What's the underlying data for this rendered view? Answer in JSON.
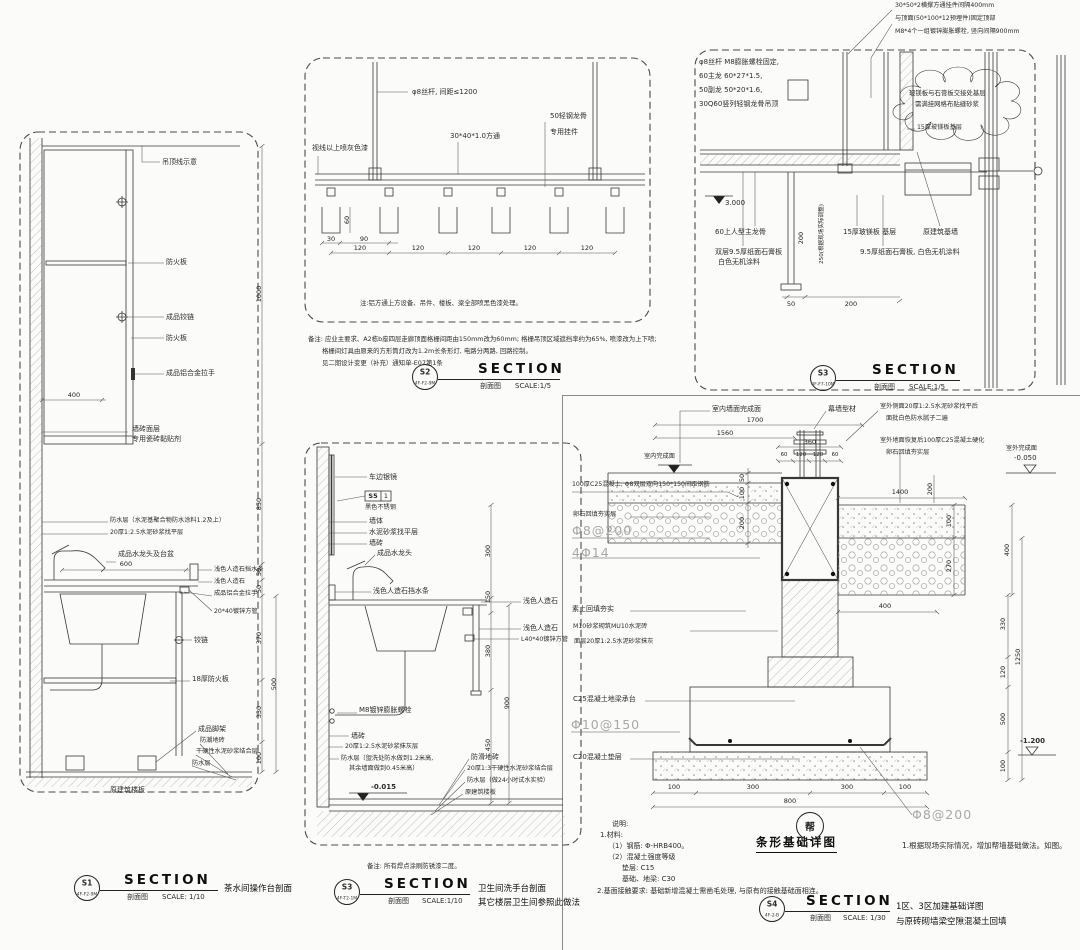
{
  "s1": {
    "lbl_ceiling": "吊顶线示意",
    "lbl_fireboard_a": "防火板",
    "lbl_hinge_a": "成品铰链",
    "lbl_fireboard_b": "防火板",
    "lbl_handle_a": "成品铝合金拉手",
    "dim_400": "400",
    "lbl_tile_a": "墙砖面层",
    "lbl_tile_b": "专用瓷砖黏贴剂",
    "lbl_wp_a": "防水层（水泥基聚合物防水涂料1.2及上）",
    "lbl_screed": "20厚1:2.5水泥砂浆找平层",
    "lbl_faucet": "成品水龙头及台盆",
    "dim_600": "600",
    "lbl_splash": "浅色人造石挡水条",
    "lbl_stone": "浅色人造石",
    "lbl_handle_b": "成品铝合金拉手",
    "lbl_tube": "20*40镀锌方管",
    "lbl_hinge_b": "铰链",
    "lbl_board18": "18厚防火板",
    "lbl_feet": "成品脚架",
    "lbl_floor_tile": "防潮地砖",
    "lbl_bond": "干硬性水泥砂浆结合层",
    "lbl_wp_b": "防水层",
    "lbl_slab": "原建筑楼板",
    "dim_1000": "1000",
    "dim_850": "850",
    "dim_50a": "50",
    "dim_50b": "50",
    "dim_370": "370",
    "dim_500": "500",
    "dim_330": "330",
    "dim_100": "100",
    "badge": {
      "id": "S1",
      "code": "4F-F2-9M",
      "sec": "SECTION",
      "cn": "剖面图",
      "scale": "SCALE: 1/10",
      "caption": "茶水间操作台剖面"
    }
  },
  "s2": {
    "lbl_rod": "φ8丝杆, 间距≤1200",
    "lbl_tube": "30*40*1.0方通",
    "lbl_keel": "50轻钢龙骨",
    "lbl_clip": "专用挂件",
    "lbl_paint": "视线以上喷灰色漆",
    "dim_60": "60",
    "dim_30": "30",
    "dim_90": "90",
    "dim_120": "120",
    "note": "注:铝方通上方设备、吊件、楼板、梁全部喷黑色漆处理。",
    "remark1": "备注: 应业主要求、A2栋b座四层走廊顶面格栅间距由150mm改为60mm; 格栅吊顶区域遮挡率约为65%, 喷漆改为上下喷;",
    "remark2": "格栅间灯具由原来的方形筒灯改为1.2m长条形灯, 电路分两路, 回路控制。",
    "remark3": "见二期设计变更（补充）通知单-E07第1条",
    "badge": {
      "id": "S2",
      "code": "4F-F2-9M",
      "sec": "SECTION",
      "cn": "剖面图",
      "scale": "SCALE:1/5"
    }
  },
  "s3": {
    "top1": "30*50*2横撑方通挂件间隔400mm",
    "top2": "与顶面(50*100*12预埋件)固定顶部",
    "top3": "M8*4个一组镀锌膨胀螺栓, 竖向间隔900mm",
    "left1": "φ8丝杆 M8膨胀螺栓固定,",
    "left2": "60主龙 60*27*1.5,",
    "left3": "50副龙 50*20*1.6,",
    "left4": "30Q60竖列轻钢龙骨吊顶",
    "cloud1": "玻镁板与石膏板交接处基层",
    "cloud2": "需满挂网格布贴缝砂浆",
    "lbl_mg15": "15厚玻镁板基层",
    "elev": "3.000",
    "lbl_keel": "60上人型主龙骨",
    "lbl_gyp_a1": "双层9.5厚纸面石膏板",
    "lbl_gyp_a2": "白色无机涂料",
    "lbl_mg_base": "15厚玻镁板 基层",
    "lbl_wall": "原建筑基墙",
    "lbl_gyp_b": "9.5厚纸面石膏板, 白色无机涂料",
    "dim_50": "50",
    "dim_200": "200",
    "vdim_200": "200",
    "vnote": "250(根据现场实际调整)",
    "badge": {
      "id": "S3",
      "code": "4F-F7-10M",
      "sec": "SECTION",
      "cn": "剖面图",
      "scale": "SCALE:1/5"
    }
  },
  "s5": {
    "lbl_mirror": "车边银镜",
    "tag_id": "S5",
    "tag_no": "1",
    "tag_mat": "黑色不锈钢",
    "lbl_wall": "墙体",
    "lbl_level": "水泥砂浆找平层",
    "lbl_tile_a": "墙砖",
    "lbl_faucet": "成品水龙头",
    "lbl_splash": "浅色人造石挡水条",
    "lbl_stone_a": "浅色人造石",
    "lbl_stone_b": "浅色人造石",
    "lbl_angle": "L40*40镀锌方管",
    "lbl_anchor": "M8镀锌膨胀螺栓",
    "lbl_tile_b": "墙砖",
    "lbl_plaster": "20厚1:2.5水泥砂浆抹灰层",
    "lbl_wp1": "防水层（盥洗处防水做到1.2米高,",
    "lbl_wp2": "其余墙面做到0.45米高）",
    "lbl_floor": "防滑地砖",
    "lbl_bond": "20厚1:3干硬性水泥砂浆结合层",
    "lbl_wp3": "防水层（做24小时试水实验）",
    "lbl_slab": "原建筑楼板",
    "elev": "-0.015",
    "dim_300": "300",
    "dim_150": "150",
    "dim_380": "380",
    "dim_900": "900",
    "dim_450": "450",
    "note": "备注: 所有焊点涂刷防锈漆二度。",
    "badge": {
      "id": "S3",
      "code": "4F-T2-1M",
      "sec": "SECTION",
      "cn": "剖面图",
      "scale": "SCALE:1/10",
      "caption1": "卫生间洗手台剖面",
      "caption2": "其它楼层卫生间参照此做法"
    }
  },
  "s4": {
    "lbl_indoor_fin": "室内墙面完成面",
    "lbl_mullion": "幕墙型材",
    "out1a": "室外侧面20厚1:2.5水泥砂浆找平后",
    "out1b": "面批白色防水腻子二遍",
    "out2a": "室外地面恢复后100厚C25混凝土硬化",
    "out2b": "卵石回填夯实层",
    "lbl_indoor": "室内完成面",
    "lbl_outdoor": "室外完成面",
    "elev_out": "-0.050",
    "lbl_slab100": "100厚C25混凝土, Φ8双层双向150*150间距钢筋",
    "lbl_pebble": "卵石回填夯实层",
    "reb1": "Φ8@200",
    "reb2": "4Φ14",
    "reb3": "Φ10@150",
    "reb4": "Φ8@200",
    "lbl_soil": "素土回填夯实",
    "lbl_brick": "M10砂浆砌筑MU10水泥砖",
    "lbl_face20": "面层20厚1:2.5水泥砂浆抹灰",
    "lbl_beam": "C25混凝土地梁承台",
    "lbl_cushion": "C20混凝土垫层",
    "d1700": "1700",
    "d1560": "1560",
    "d360": "360",
    "d60a": "60",
    "d120a": "120",
    "d120b": "120",
    "d60b": "60",
    "d50": "50",
    "d100a": "100",
    "d200a": "200",
    "d1400": "1400",
    "d100b": "100",
    "d270": "270",
    "d200b": "200",
    "d400a": "400",
    "d400b": "400",
    "d330": "330",
    "d120c": "120",
    "d500": "500",
    "d100c": "100",
    "d1250": "1250",
    "elev_bottom": "-1.200",
    "b100a": "100",
    "b300a": "300",
    "b300b": "300",
    "b100b": "100",
    "b800": "800",
    "detail_mark": "帮",
    "detail_title": "条形基础详图",
    "detail_note": "1.根据现场实际情况，增加帮墙基础做法。如图。",
    "note_t": "说明:",
    "note_1": "1.材料:",
    "note_1a": "（1）钢筋: Φ-HRB400。",
    "note_1b": "（2）混凝土强度等级",
    "note_1c": "垫层: C15",
    "note_1d": "基础、地梁: C30",
    "note_2": "2.基面接触要求: 基础新增混凝土需凿毛处理, 与原有的接触基础面相连。",
    "badge": {
      "id": "S4",
      "code": "4F-2-B",
      "sec": "SECTION",
      "cn": "剖面图",
      "scale": "SCALE: 1/30",
      "caption1": "1区、3区加建基础详图",
      "caption2": "与原砖砌墙梁空隙混凝土回填"
    }
  }
}
